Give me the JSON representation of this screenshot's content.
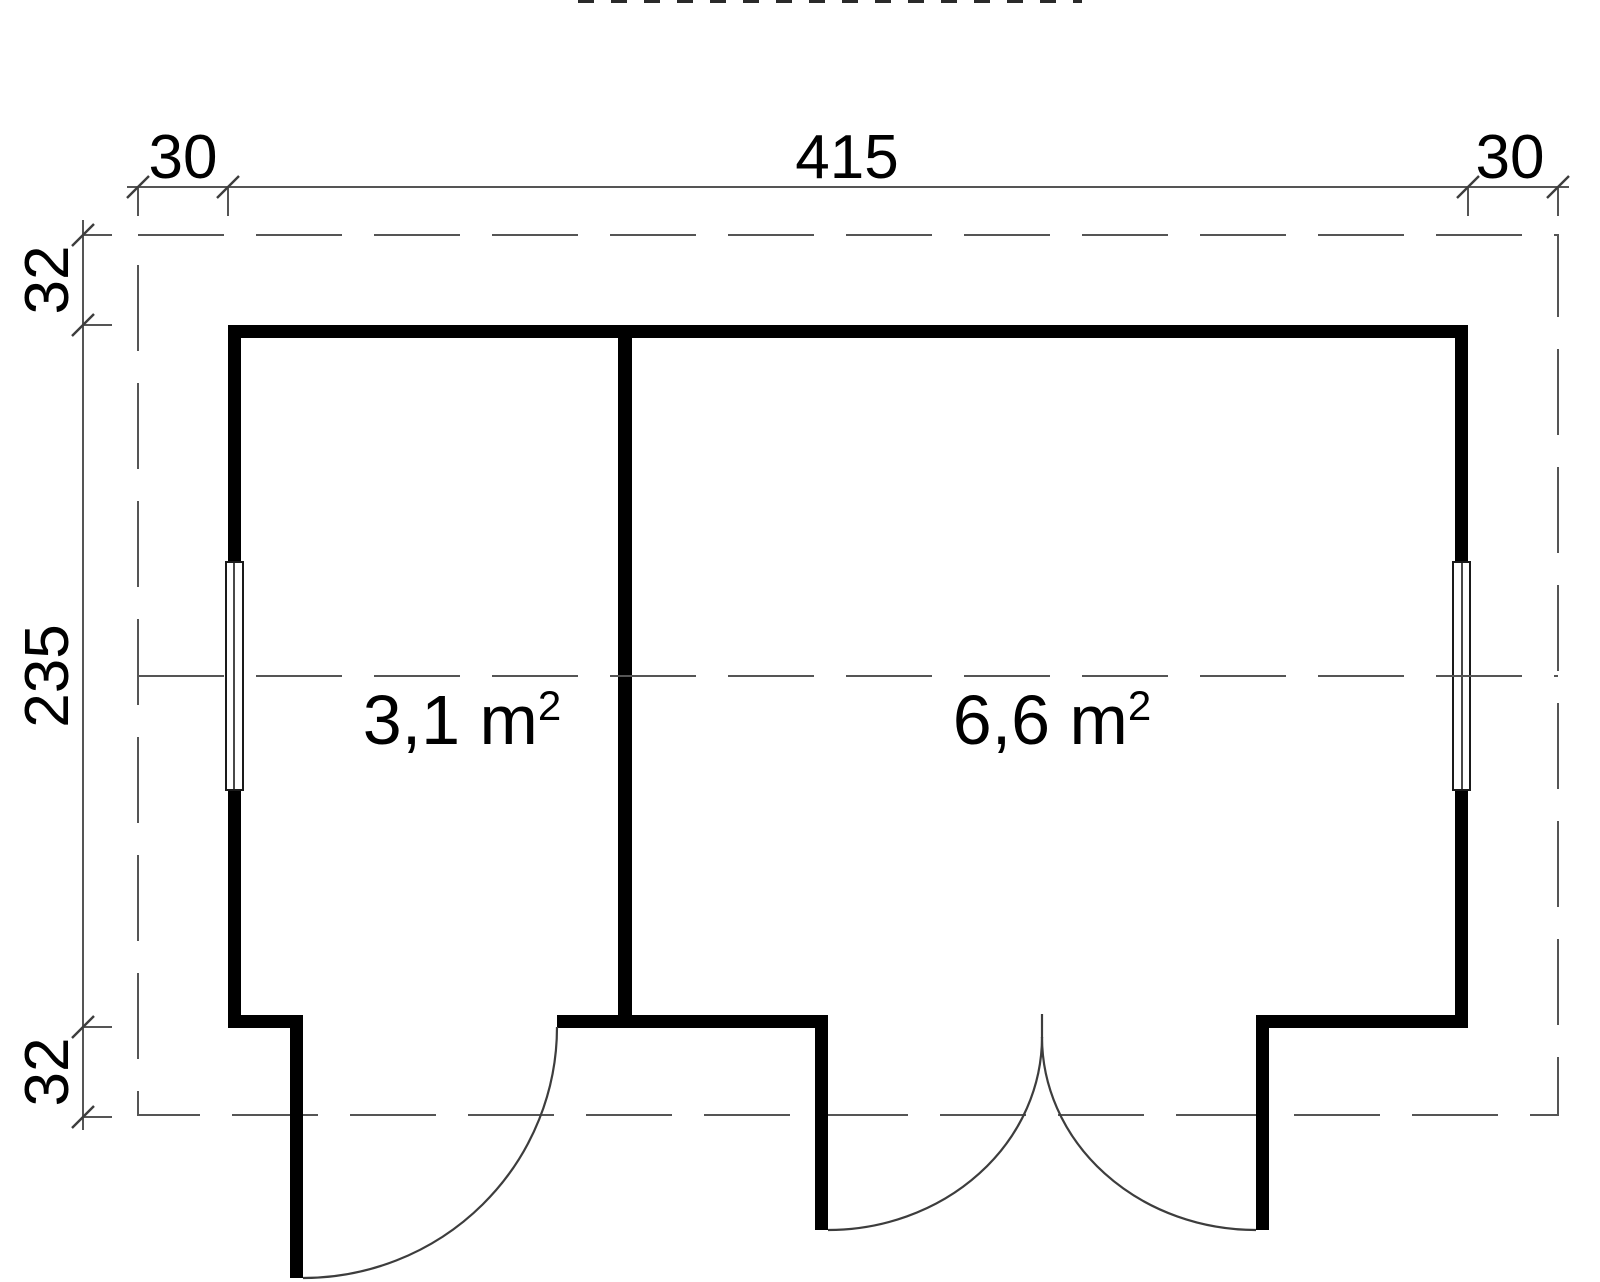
{
  "plan": {
    "top_dimensions": {
      "left": "30",
      "center": "415",
      "right": "30"
    },
    "left_dimensions": {
      "top": "32",
      "middle": "235",
      "bottom": "32"
    },
    "rooms": [
      {
        "area_value": "3,1 m",
        "area_exponent": "2"
      },
      {
        "area_value": "6,6 m",
        "area_exponent": "2"
      }
    ]
  },
  "colors": {
    "wall": "#000000",
    "thin_line": "#555555",
    "text": "#000000",
    "background": "#ffffff"
  }
}
